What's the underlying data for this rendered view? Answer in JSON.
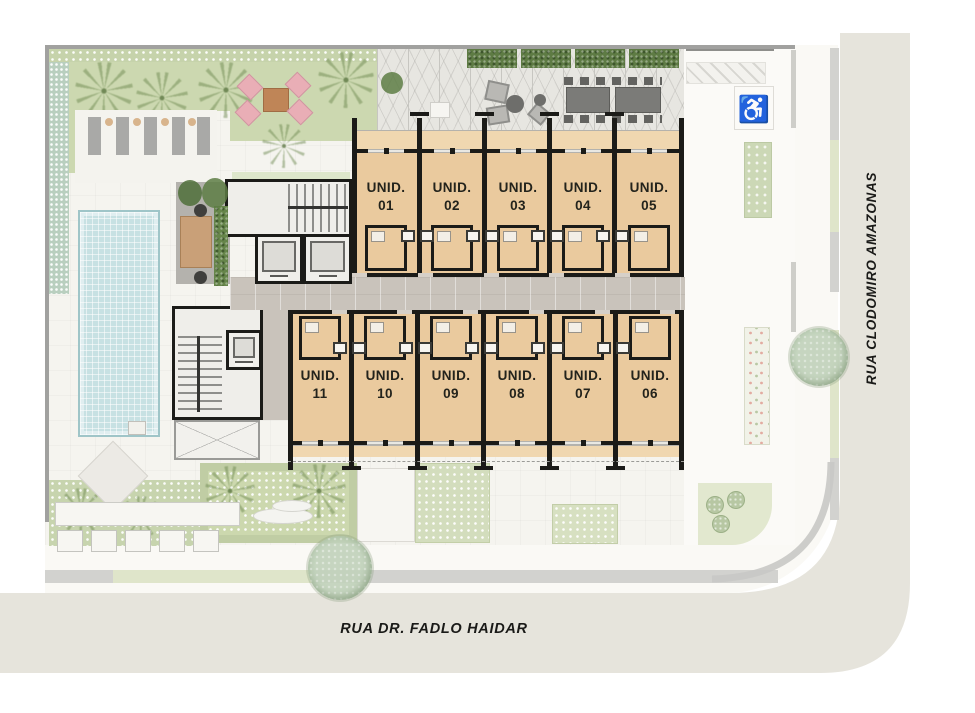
{
  "streets": {
    "bottom_label": "RUA DR. FADLO HAIDAR",
    "right_label": "RUA CLODOMIRO AMAZONAS"
  },
  "units": {
    "top": [
      {
        "prefix": "UNID.",
        "number": "01"
      },
      {
        "prefix": "UNID.",
        "number": "02"
      },
      {
        "prefix": "UNID.",
        "number": "03"
      },
      {
        "prefix": "UNID.",
        "number": "04"
      },
      {
        "prefix": "UNID.",
        "number": "05"
      }
    ],
    "bottom": [
      {
        "prefix": "UNID.",
        "number": "11"
      },
      {
        "prefix": "UNID.",
        "number": "10"
      },
      {
        "prefix": "UNID.",
        "number": "09"
      },
      {
        "prefix": "UNID.",
        "number": "08"
      },
      {
        "prefix": "UNID.",
        "number": "07"
      },
      {
        "prefix": "UNID.",
        "number": "06"
      }
    ]
  },
  "icons": {
    "accessible_parking": "♿"
  },
  "colors": {
    "unit_fill": "#eaca9e",
    "wall": "#1b1b18",
    "pool": "#c7e1e3",
    "lawn": "#ccd8b0",
    "street": "#e6e4dc",
    "corridor": "#c9c3bb",
    "balcony": "#f0d7b0"
  }
}
